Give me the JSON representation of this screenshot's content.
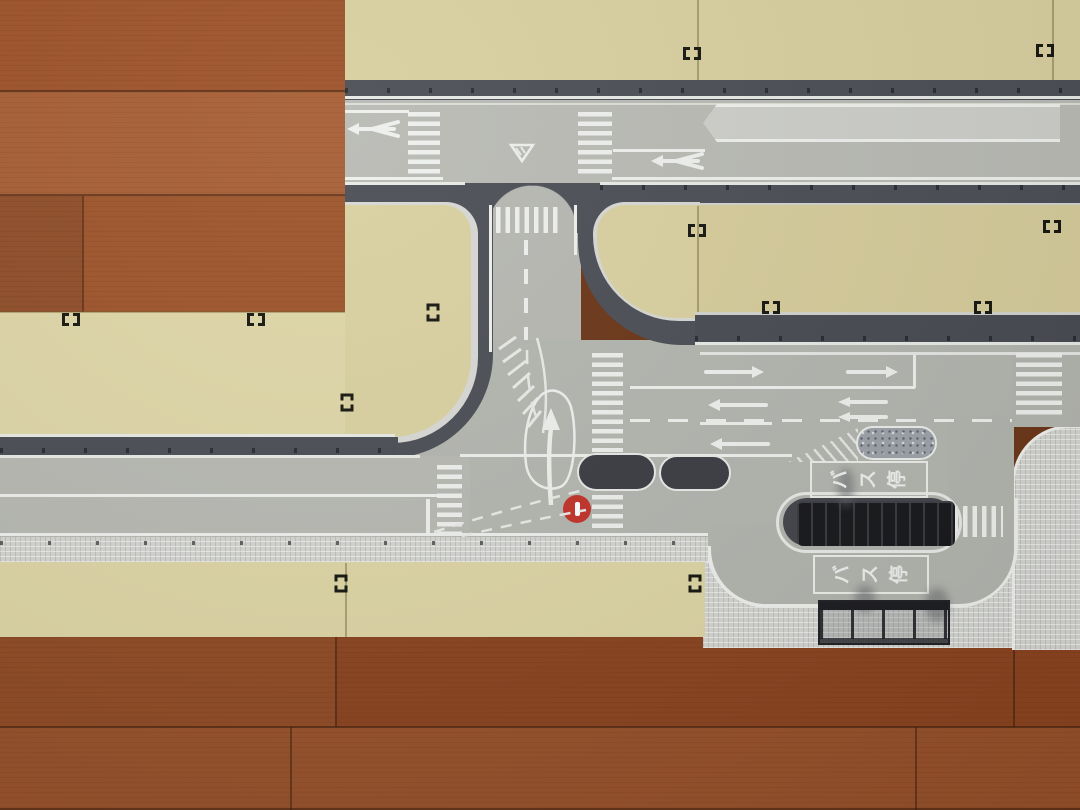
{
  "scene": {
    "description": "Overhead photo of a toy town road-plate layout assembled on a wooden floor",
    "floor": "wood planks",
    "plates": "tan plastic plates with printed gray roads"
  },
  "palette": {
    "wood_dark": "#8a431f",
    "wood_mid": "#9c5329",
    "plate_beige": "#d9d0a0",
    "asphalt": "#b5b6b0",
    "curb_dark": "#4b4d55",
    "marking_white": "#eef0ed",
    "sidewalk_light": "#d4d5d1",
    "island_dark": "#3a3c42",
    "no_entry_red": "#c23229"
  },
  "road_markings": {
    "bus_stop_label": {
      "text": "バス停",
      "chars": [
        "バ",
        "ス",
        "停"
      ]
    },
    "no_entry": {
      "shape": "red circle with white bar"
    },
    "yield": {
      "shape": "inverted outlined triangle"
    },
    "crosswalk_count": 7,
    "arrow_counts": {
      "left": 3,
      "right": 2,
      "double_left": 2,
      "fork_left": 2,
      "turn_up": 1
    }
  },
  "objects": {
    "bus_platform": "black platform piece in bus bay",
    "bus_shelter": "black frame shelter on sidewalk",
    "refuge_island": "gray speckled raised island",
    "channel_islands": 2
  }
}
